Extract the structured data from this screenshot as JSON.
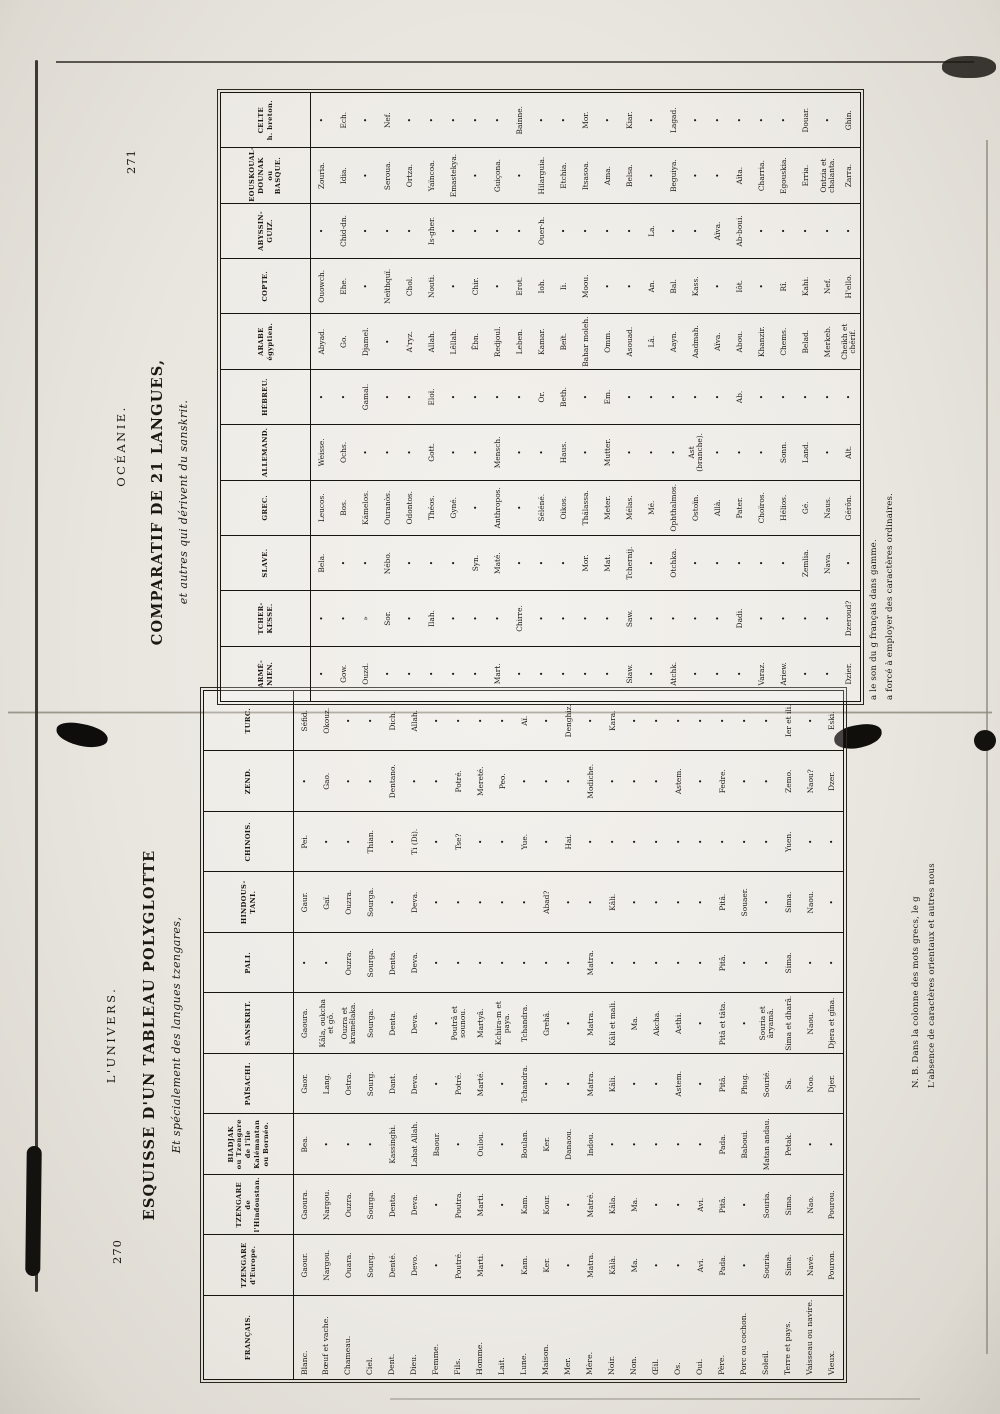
{
  "left_page": {
    "page_number": "270",
    "running_title": "L'UNIVERS.",
    "title": "ESQUISSE D'UN TABLEAU POLYGLOTTE",
    "subtitle": "Et spécialement des langues tzengares,",
    "footnote_line1": "N. B. Dans la colonne des mots grecs, le g",
    "footnote_line2": "L'absence de caractères orientaux et autres nous",
    "table": {
      "headers": [
        "FRANÇAIS.",
        "TZENGARE\nd'Europe.",
        "TZENGARE\nde\nl'Hindoustan.",
        "BIADJAK\nou Tzengare\nde l'île\nKalémantan\nou Bornéo.",
        "PAÏSACHI.",
        "SANSKRIT.",
        "PALI.",
        "HINDOUS-\nTANI.",
        "CHINOIS.",
        "ZEND.",
        "TURC."
      ],
      "rows": [
        [
          "Blanc.",
          "Gaour.",
          "Gaoura.",
          "Bea.",
          "Gaor.",
          "Gaoura.",
          "•",
          "Gaur.",
          "Pei.",
          "•",
          "Séfid."
        ],
        [
          "Bœuf et vache.",
          "Nargou.",
          "Nargou.",
          "•",
          "Lang.",
          "Kâla, oukcha et gô.",
          "•",
          "Gaï.",
          "•",
          "Gao.",
          "Okouz."
        ],
        [
          "Chameau.",
          "Ouara.",
          "Ouzra.",
          "•",
          "Ostra.",
          "Ouzra et kramêlaka.",
          "Ouzra.",
          "Ouzra.",
          "•",
          "•",
          "•"
        ],
        [
          "Ciel.",
          "Sourg.",
          "Sourga.",
          "•",
          "Sourg.",
          "Sourga.",
          "Sourga.",
          "Sourga.",
          "Thian.",
          "•",
          "•"
        ],
        [
          "Dent.",
          "Denté.",
          "Denta.",
          "Kassinghi.",
          "Dant.",
          "Denta.",
          "Denta.",
          "•",
          "•",
          "Dentano.",
          "Dich."
        ],
        [
          "Dieu.",
          "Devo.",
          "Deva.",
          "Lahat Allah.",
          "Deva.",
          "Deva.",
          "Deva.",
          "Deva.",
          "Ti (Di).",
          "•",
          "Allah."
        ],
        [
          "Femme.",
          "•",
          "•",
          "Baour.",
          "•",
          "•",
          "•",
          "•",
          "•",
          "•",
          "•"
        ],
        [
          "Fils.",
          "Poutré.",
          "Poutra.",
          "•",
          "Potré.",
          "Poutrâ et sounou.",
          "•",
          "•",
          "Tse?",
          "Potré.",
          "•"
        ],
        [
          "Homme.",
          "Marti.",
          "Marti.",
          "Oulou.",
          "Marté.",
          "Martyâ.",
          "•",
          "•",
          "•",
          "Mereté.",
          "•"
        ],
        [
          "Lait.",
          "•",
          "•",
          "•",
          "•",
          "Kchira-m et paya.",
          "•",
          "•",
          "•",
          "Peo.",
          "•"
        ],
        [
          "Lune.",
          "Kam.",
          "Kam.",
          "Boulan.",
          "Tchandra.",
          "Tchandra.",
          "•",
          "•",
          "Yue.",
          "•",
          "Aï."
        ],
        [
          "Maison.",
          "Ker.",
          "Kour.",
          "Ker.",
          "•",
          "Grehâ.",
          "•",
          "Abad?",
          "•",
          "•",
          "•"
        ],
        [
          "Mer.",
          "•",
          "•",
          "Danaou.",
          "•",
          "•",
          "•",
          "•",
          "Hai.",
          "•",
          "Denghiz."
        ],
        [
          "Mère.",
          "Matra.",
          "Matré.",
          "Indou.",
          "Matra.",
          "Matra.",
          "Matra.",
          "•",
          "•",
          "Modiche.",
          "•"
        ],
        [
          "Noir.",
          "Kâlà.",
          "Kâla.",
          "•",
          "Kâli.",
          "Kâli et mali.",
          "•",
          "Kâli.",
          "•",
          "•",
          "Kara."
        ],
        [
          "Non.",
          "Ma.",
          "Ma.",
          "•",
          "•",
          "Ma.",
          "•",
          "•",
          "•",
          "•",
          "•"
        ],
        [
          "Œil.",
          "•",
          "•",
          "•",
          "•",
          "Akcha.",
          "•",
          "•",
          "•",
          "•",
          "•"
        ],
        [
          "Os.",
          "•",
          "•",
          "•",
          "Astem.",
          "Asthi.",
          "•",
          "•",
          "•",
          "Astem.",
          "•"
        ],
        [
          "Oui.",
          "Avi.",
          "Avi.",
          "•",
          "•",
          "•",
          "•",
          "•",
          "•",
          "•",
          "•"
        ],
        [
          "Père.",
          "Pada.",
          "Pitâ.",
          "Pada.",
          "Pitâ.",
          "Pitâ et tâta.",
          "Pitâ.",
          "Pitâ.",
          "•",
          "Fedre.",
          "•"
        ],
        [
          "Porc ou cochon.",
          "•",
          "•",
          "Baboui.",
          "Phug.",
          "•",
          "•",
          "Souaer.",
          "•",
          "•",
          "•"
        ],
        [
          "Soleil.",
          "Souria.",
          "Souria.",
          "Matan andau.",
          "Sourié.",
          "Souria et âryamâ.",
          "•",
          "•",
          "•",
          "•",
          "•"
        ],
        [
          "Terre et pays.",
          "Sima.",
          "Sima.",
          "Petak.",
          "Sa.",
          "Sima et dharâ.",
          "Sima.",
          "Sima.",
          "Yuen.",
          "Zemo.",
          "Ier et ili."
        ],
        [
          "Vaisseau ou navire.",
          "Navé.",
          "Nao.",
          "•",
          "Noo.",
          "Naou.",
          "•",
          "Naou.",
          "•",
          "Naou?",
          "•"
        ],
        [
          "Vieux.",
          "Pouron.",
          "Pourou.",
          "•",
          "Djer.",
          "Djera et gîna.",
          "•",
          "•",
          "•",
          "Dzer.",
          "Eski."
        ]
      ]
    }
  },
  "right_page": {
    "page_number": "271",
    "running_title": "OCÉANIE.",
    "title": "COMPARATIF DE 21 LANGUES,",
    "subtitle": "et autres qui dérivent du sanskrit.",
    "footnote_line1": "a le son du g français dans gamme.",
    "footnote_line2": "a forcé à employer des caractères ordinaires.",
    "table": {
      "headers": [
        "ARMÉ-\nNIEN.",
        "TCHER-\nKESSE.",
        "SLAVE.",
        "GREC.",
        "ALLEMAND.",
        "HÉBREU.",
        "ARABE\négyptien.",
        "COPTE.",
        "ABYSSIN-\nGUIZ.",
        "EOUSKOUAL-\nDOUNAK\nou\nBASQUE.",
        "CELTE\nh. breton."
      ],
      "rows": [
        [
          "•",
          "•",
          "Bela.",
          "Leucos.",
          "Weisse.",
          "•",
          "Abyad.",
          "Ouowch.",
          "•",
          "Zouria.",
          "•"
        ],
        [
          "Gow.",
          "•",
          "•",
          "Bos.",
          "Ochs.",
          "•",
          "Go.",
          "Ehe.",
          "Chid-dn.",
          "Idia.",
          "Ech."
        ],
        [
          "Ouzd.",
          "»",
          "•",
          "Kámelos.",
          "•",
          "Gamal.",
          "Djamel.",
          "•",
          "•",
          "•",
          "•"
        ],
        [
          "•",
          "Sor.",
          "Nébo.",
          "Ouranòs.",
          "•",
          "•",
          "•",
          "Neïthquï.",
          "•",
          "Seroua.",
          "Nef."
        ],
        [
          "•",
          "•",
          "•",
          "Odontos.",
          "•",
          "•",
          "A'ryz.",
          "Chol.",
          "•",
          "Ortza.",
          "•"
        ],
        [
          "•",
          "Ilah.",
          "•",
          "Théos.",
          "Gott.",
          "Eloï.",
          "Allah.",
          "Nouti.",
          "Is-gher.",
          "Yaïncoa.",
          "•"
        ],
        [
          "•",
          "•",
          "•",
          "Gyné.",
          "•",
          "•",
          "Lêllah.",
          "•",
          "•",
          "Emastekya.",
          "•"
        ],
        [
          "•",
          "•",
          "Syn.",
          "•",
          "•",
          "•",
          "Êbn.",
          "Chir.",
          "•",
          "•",
          "•"
        ],
        [
          "Mart.",
          "•",
          "Maté.",
          "Anthropos.",
          "Mensch.",
          "•",
          "Redjoul.",
          "•",
          "•",
          "Guiçona.",
          "•"
        ],
        [
          "•",
          "Chirre.",
          "•",
          "•",
          "•",
          "•",
          "Leben.",
          "Erot.",
          "•",
          "•",
          "Bainne."
        ],
        [
          "•",
          "•",
          "•",
          "Séléné.",
          "•",
          "Or.",
          "Kamar.",
          "Ioh.",
          "Ouer-h.",
          "Hilarguia.",
          "•"
        ],
        [
          "•",
          "•",
          "•",
          "Oikos.",
          "Haus.",
          "Beth.",
          "Beït.",
          "Ii.",
          "•",
          "Etchia.",
          "•"
        ],
        [
          "•",
          "•",
          "Mor.",
          "Thálassa.",
          "•",
          "•",
          "Bahar moleh.",
          "Moou.",
          "•",
          "Itsasoa.",
          "Mor."
        ],
        [
          "•",
          "•",
          "Mat.",
          "Meter.",
          "Mutter.",
          "Em.",
          "Omm.",
          "•",
          "•",
          "Ama.",
          "•"
        ],
        [
          "Siaw.",
          "Saw.",
          "Tchernij.",
          "Mélas.",
          "•",
          "•",
          "Asouad.",
          "•",
          "•",
          "Belsa.",
          "Kiar."
        ],
        [
          "•",
          "•",
          "•",
          "Mé.",
          "•",
          "•",
          "Lâ.",
          "An.",
          "La.",
          "•",
          "•"
        ],
        [
          "Atchk.",
          "•",
          "Otchka.",
          "Ophthalmos.",
          "•",
          "•",
          "Aayn.",
          "Bal.",
          "•",
          "Beguiya.",
          "Lagad."
        ],
        [
          "•",
          "•",
          "•",
          "Ostoïn.",
          "Ast (branche).",
          "•",
          "Aadmah.",
          "Kass.",
          "•",
          "•",
          "•"
        ],
        [
          "•",
          "•",
          "•",
          "Allà.",
          "•",
          "•",
          "Aïva.",
          "•",
          "Aïva.",
          "•",
          "•"
        ],
        [
          "•",
          "Dadi.",
          "•",
          "Pater.",
          "•",
          "Ab.",
          "Abou.",
          "Iôt.",
          "Ab-boui.",
          "Aïta.",
          "•"
        ],
        [
          "Varaz.",
          "•",
          "•",
          "Choïros.",
          "•",
          "•",
          "Khanzir.",
          "•",
          "•",
          "Charria.",
          "•"
        ],
        [
          "Ariew.",
          "•",
          "•",
          "Hélios.",
          "Sonn.",
          "•",
          "Chems.",
          "Rî.",
          "•",
          "Egouskia.",
          "•"
        ],
        [
          "•",
          "•",
          "Zemlia.",
          "Gé.",
          "Land.",
          "•",
          "Belad.",
          "Kahi.",
          "•",
          "Erria.",
          "Douar."
        ],
        [
          "•",
          "•",
          "Nava.",
          "Naus.",
          "•",
          "•",
          "Merkeb.",
          "Nef.",
          "•",
          "Ontzia et chalanta.",
          "•"
        ],
        [
          "Dzier.",
          "Dzeroud?",
          "•",
          "Gérôn.",
          "Alt.",
          "•",
          "Cheikh et chérif.",
          "H'ello.",
          "•",
          "Zarra.",
          "Ghin."
        ]
      ]
    }
  }
}
